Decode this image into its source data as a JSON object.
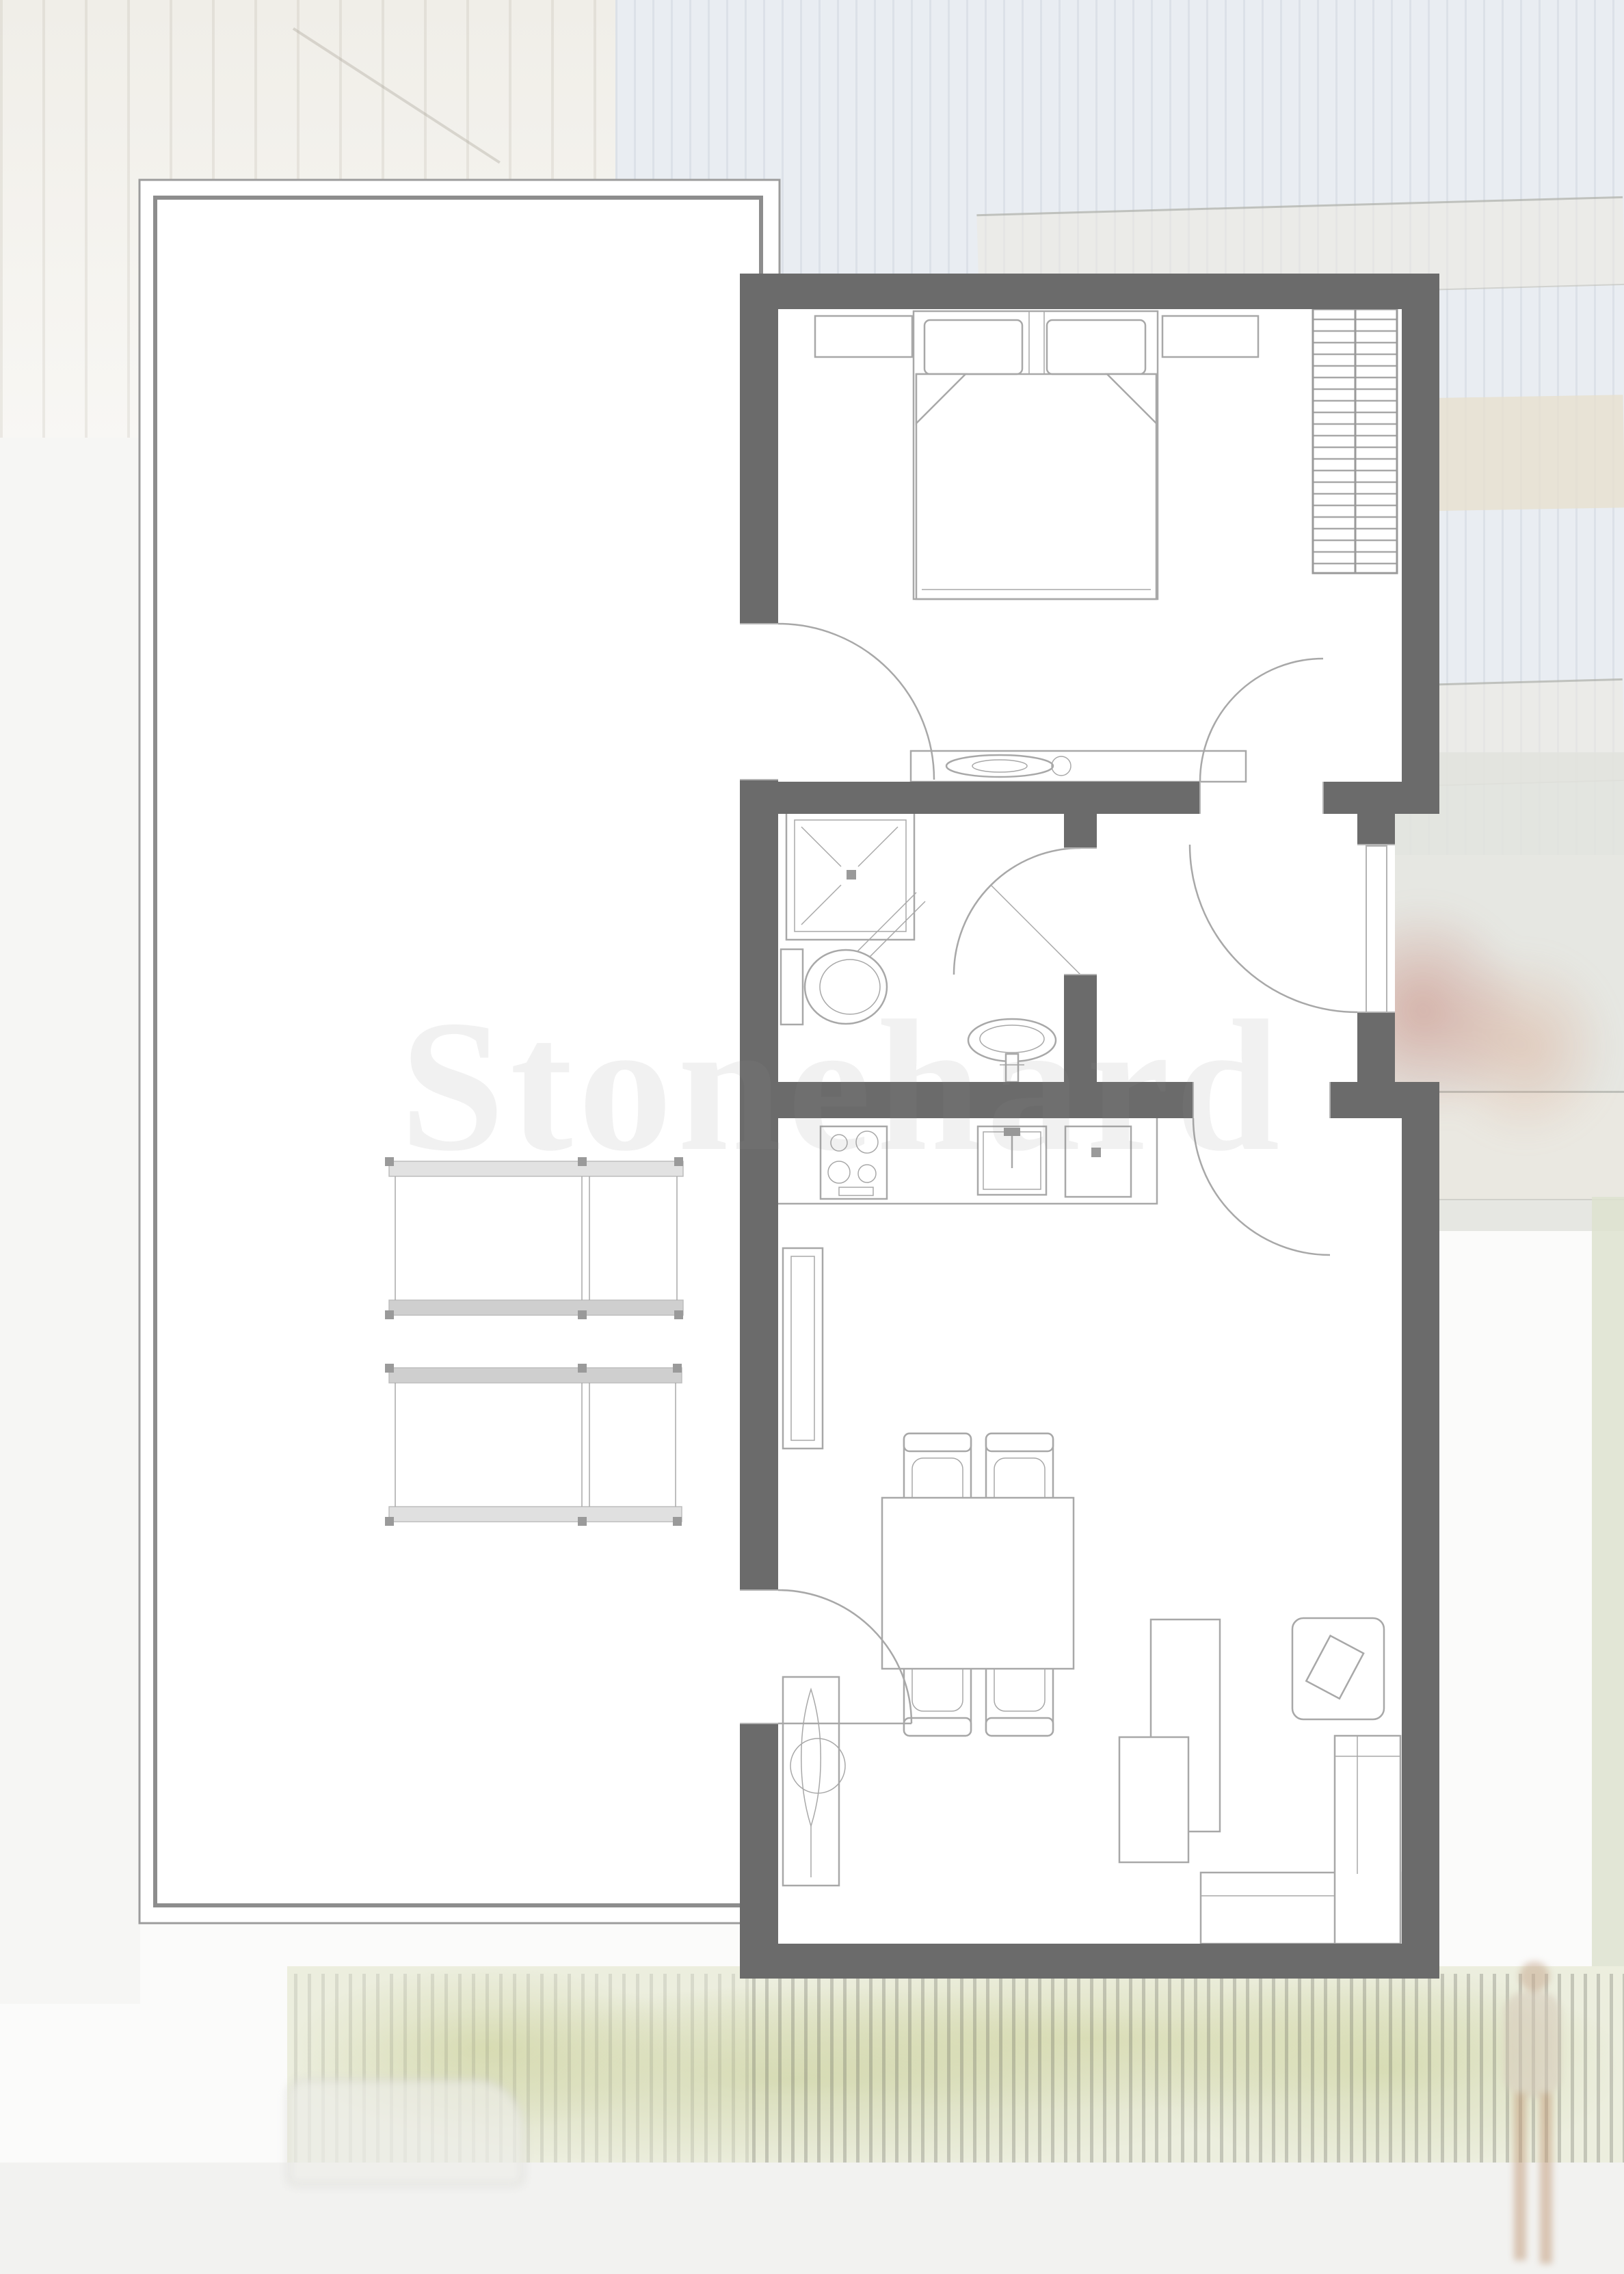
{
  "watermark": {
    "text": "Stonehard"
  },
  "colors": {
    "wall": "#6b6b6b",
    "floor": "#ffffff",
    "line": "#a8a8a8",
    "background": "#fbfbfa",
    "terrace_outer": "#9c9c9c",
    "terrace_inner": "#8d8d8d",
    "sky": "#e9edf2",
    "foliage": "#eceede",
    "accent_plant": "#bd6154"
  },
  "plan": {
    "rooms": [
      "bedroom",
      "bathroom",
      "hallway",
      "kitchen-living-room",
      "terrace"
    ],
    "furniture": [
      "double-bed",
      "nightstand",
      "wardrobe",
      "dressing-table",
      "shower",
      "toilet",
      "washbasin",
      "stove",
      "kitchen-sink",
      "kitchen-unit",
      "radiator",
      "dining-table",
      "chair",
      "coffee-table",
      "side-table",
      "corner-sofa",
      "plant",
      "terrace-table"
    ]
  }
}
